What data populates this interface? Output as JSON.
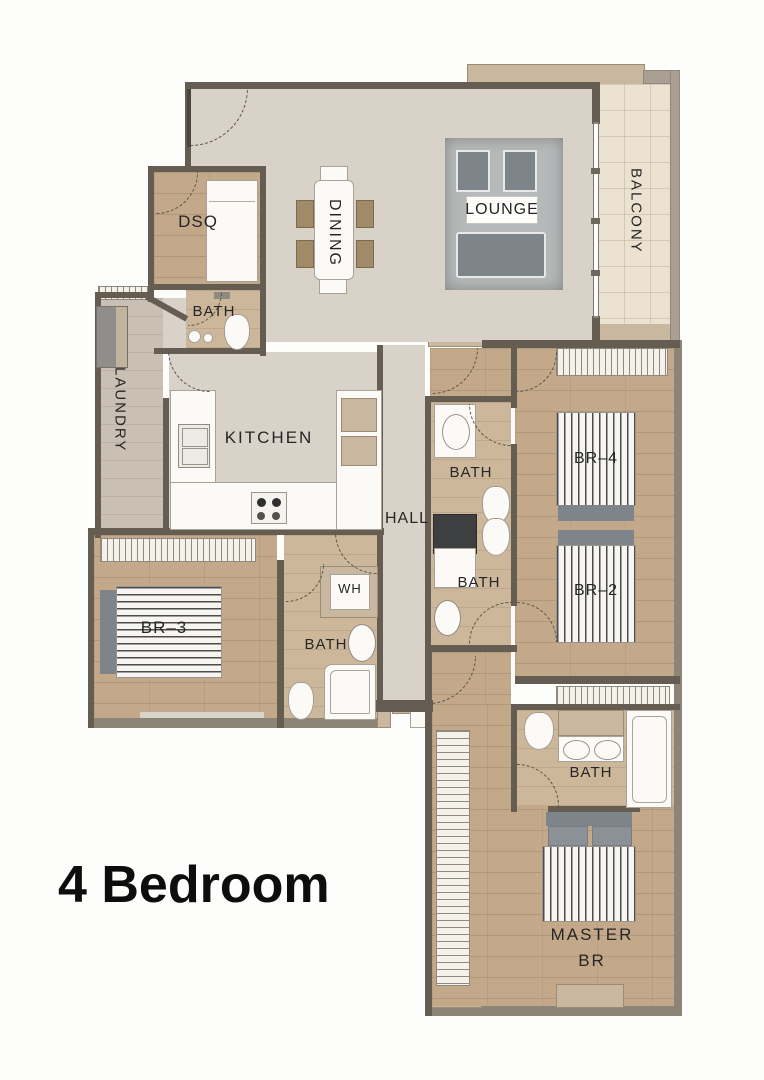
{
  "title": "4 Bedroom",
  "rooms": {
    "dsq": "DSQ",
    "dining": "DINING",
    "lounge": "LOUNGE",
    "balcony": "BALCONY",
    "bath_dsq": "BATH",
    "laundry": "LAUNDRY",
    "kitchen": "KITCHEN",
    "hall": "HALL",
    "bath_upper": "BATH",
    "bath_lower": "BATH",
    "br4": "BR–4",
    "br2": "BR–2",
    "br3": "BR–3",
    "wh": "WH",
    "bath_br3": "BATH",
    "bath_master": "BATH",
    "master_line1": "MASTER",
    "master_line2": "BR"
  },
  "theme": {
    "wall": "#655d52",
    "pier": "#c9b7a0",
    "liv": "#d9d2c9",
    "wood": "#c3a98a",
    "woodL": "#cdb79b",
    "balc": "#ece2d1",
    "furn": "#7e858a",
    "ink": "#262626"
  }
}
